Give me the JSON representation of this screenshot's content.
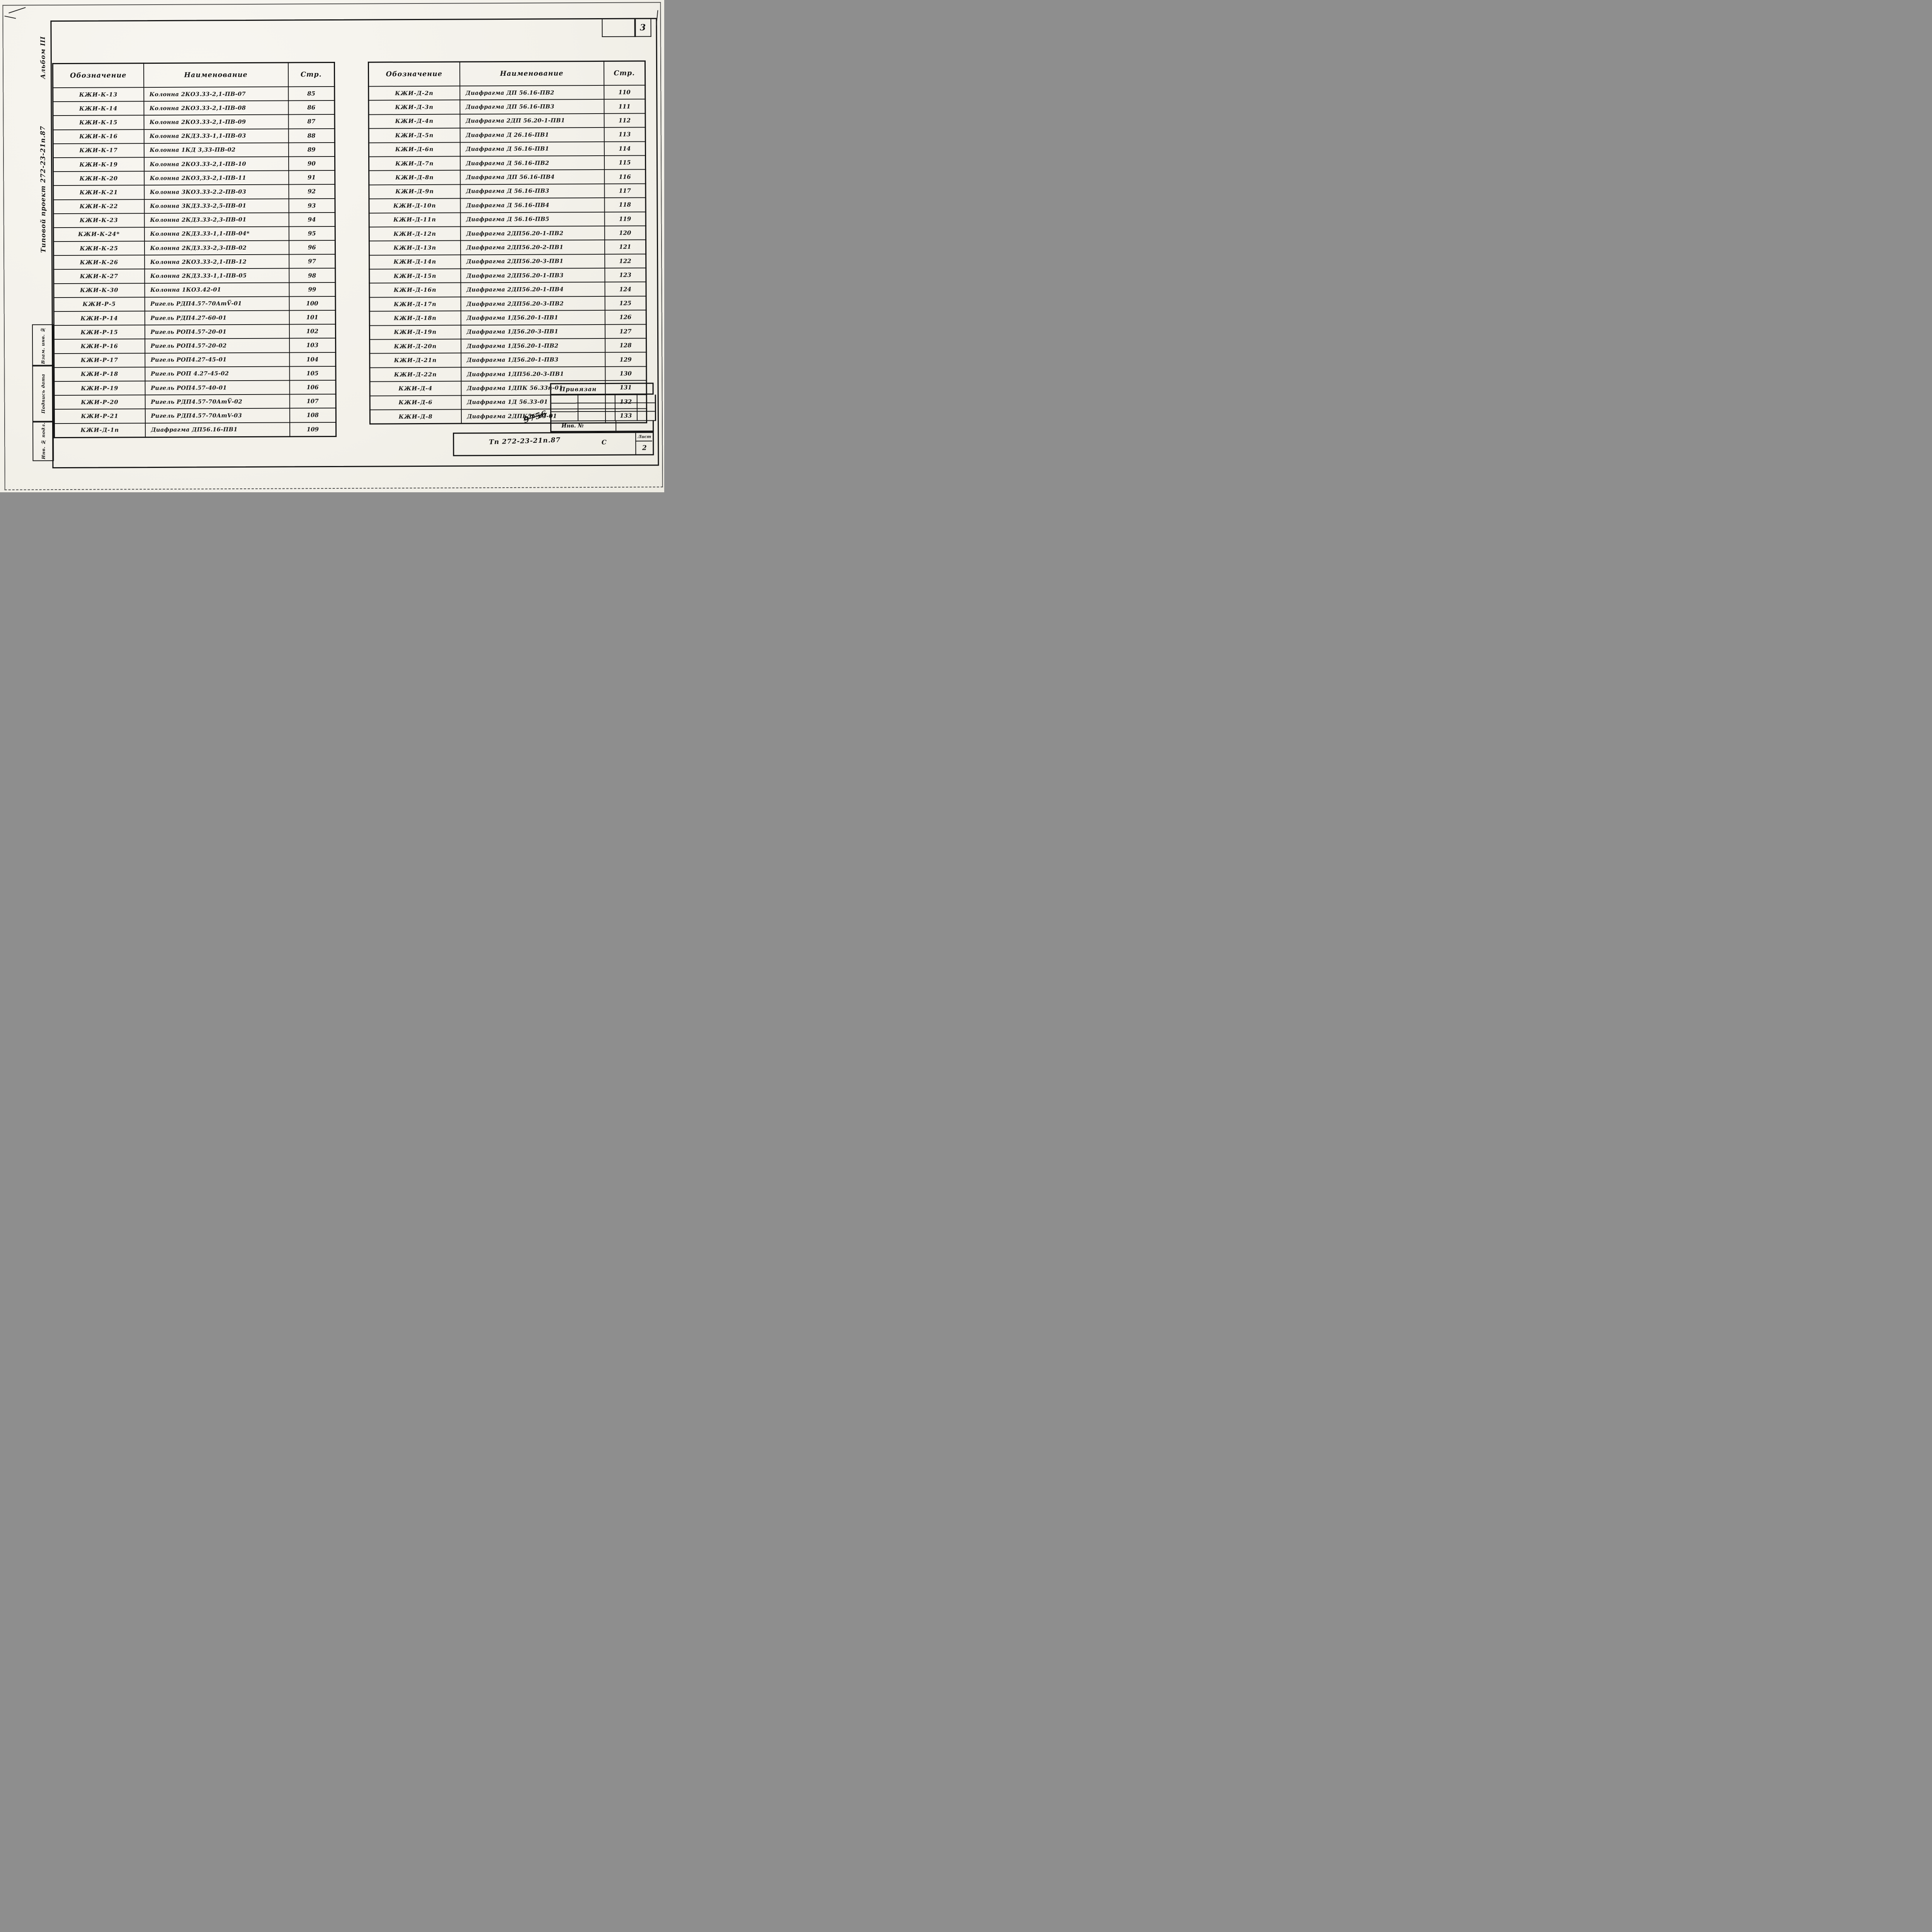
{
  "page": {
    "sheet_number_top": "3",
    "sheet_number_bottom": "2"
  },
  "margin": {
    "album": "Альбом III",
    "project": "Типовой проект 272-23-21п.87",
    "stamps": [
      "Взам. инв. №",
      "Подпись дата",
      "Инв. № подл."
    ]
  },
  "tables": {
    "headers": {
      "designation": "Обозначение",
      "name": "Наименование",
      "page": "Стр."
    },
    "left": {
      "rows": [
        [
          "КЖИ-К-13",
          "Колонна 2КО3.33-2,1-ПВ-07",
          "85"
        ],
        [
          "КЖИ-К-14",
          "Колонна 2КО3.33-2,1-ПВ-08",
          "86"
        ],
        [
          "КЖИ-К-15",
          "Колонна 2КО3.33-2,1-ПВ-09",
          "87"
        ],
        [
          "КЖИ-К-16",
          "Колонна 2КД3.33-1,1-ПВ-03",
          "88"
        ],
        [
          "КЖИ-К-17",
          "Колонна 1КД 3,33-ПВ-02",
          "89"
        ],
        [
          "КЖИ-К-19",
          "Колонна 2КО3.33-2,1-ПВ-10",
          "90"
        ],
        [
          "КЖИ-К-20",
          "Колонна 2КО3,33-2,1-ПВ-11",
          "91"
        ],
        [
          "КЖИ-К-21",
          "Колонна 3КО3.33-2.2-ПВ-03",
          "92"
        ],
        [
          "КЖИ-К-22",
          "Колонна 3КД3.33-2,5-ПВ-01",
          "93"
        ],
        [
          "КЖИ-К-23",
          "Колонна 2КД3.33-2,3-ПВ-01",
          "94"
        ],
        [
          "КЖИ-К-24*",
          "Колонна 2КД3.33-1,1-ПВ-04*",
          "95"
        ],
        [
          "КЖИ-К-25",
          "Колонна 2КД3.33-2,3-ПВ-02",
          "96"
        ],
        [
          "КЖИ-К-26",
          "Колонна 2КО3.33-2,1-ПВ-12",
          "97"
        ],
        [
          "КЖИ-К-27",
          "Колонна 2КД3.33-1,1-ПВ-05",
          "98"
        ],
        [
          "КЖИ-К-30",
          "Колонна 1КО3.42-01",
          "99"
        ],
        [
          "КЖИ-Р-5",
          "Ригель РДП4.57-70АтV̅-01",
          "100"
        ],
        [
          "КЖИ-Р-14",
          "Ригель РДП4.27-60-01",
          "101"
        ],
        [
          "КЖИ-Р-15",
          "Ригель РОП4.57-20-01",
          "102"
        ],
        [
          "КЖИ-Р-16",
          "Ригель РОП4.57-20-02",
          "103"
        ],
        [
          "КЖИ-Р-17",
          "Ригель РОП4.27-45-01",
          "104"
        ],
        [
          "КЖИ-Р-18",
          "Ригель РОП 4.27-45-02",
          "105"
        ],
        [
          "КЖИ-Р-19",
          "Ригель РОП4.57-40-01",
          "106"
        ],
        [
          "КЖИ-Р-20",
          "Ригель РДП4.57-70АтV̅-02",
          "107"
        ],
        [
          "КЖИ-Р-21",
          "Ригель РДП4.57-70АтV-03",
          "108"
        ],
        [
          "КЖИ-Д-1п",
          "Диафрагма ДП56.16-ПВ1",
          "109"
        ]
      ]
    },
    "right": {
      "rows": [
        [
          "КЖИ-Д-2п",
          "Диафрагма ДП 56.16-ПВ2",
          "110"
        ],
        [
          "КЖИ-Д-3п",
          "Диафрагма ДП 56.16-ПВ3",
          "111"
        ],
        [
          "КЖИ-Д-4п",
          "Диафрагма 2ДП 56.20-1-ПВ1",
          "112"
        ],
        [
          "КЖИ-Д-5п",
          "Диафрагма Д 26.16-ПВ1",
          "113"
        ],
        [
          "КЖИ-Д-6п",
          "Диафрагма Д 56.16-ПВ1",
          "114"
        ],
        [
          "КЖИ-Д-7п",
          "Диафрагма Д 56.16-ПВ2",
          "115"
        ],
        [
          "КЖИ-Д-8п",
          "Диафрагма ДП 56.16-ПВ4",
          "116"
        ],
        [
          "КЖИ-Д-9п",
          "Диафрагма Д 56.16-ПВ3",
          "117"
        ],
        [
          "КЖИ-Д-10п",
          "Диафрагма Д 56.16-ПВ4",
          "118"
        ],
        [
          "КЖИ-Д-11п",
          "Диафрагма Д 56.16-ПВ5",
          "119"
        ],
        [
          "КЖИ-Д-12п",
          "Диафрагма 2ДП56.20-1-ПВ2",
          "120"
        ],
        [
          "КЖИ-Д-13п",
          "Диафрагма 2ДП56.20-2-ПВ1",
          "121"
        ],
        [
          "КЖИ-Д-14п",
          "Диафрагма 2ДП56.20-3-ПВ1",
          "122"
        ],
        [
          "КЖИ-Д-15п",
          "Диафрагма 2ДП56.20-1-ПВ3",
          "123"
        ],
        [
          "КЖИ-Д-16п",
          "Диафрагма 2ДП56.20-1-ПВ4",
          "124"
        ],
        [
          "КЖИ-Д-17п",
          "Диафрагма 2ДП56.20-3-ПВ2",
          "125"
        ],
        [
          "КЖИ-Д-18п",
          "Диафрагма 1Д56.20-1-ПВ1",
          "126"
        ],
        [
          "КЖИ-Д-19п",
          "Диафрагма 1Д56.20-3-ПВ1",
          "127"
        ],
        [
          "КЖИ-Д-20п",
          "Диафрагма 1Д56.20-1-ПВ2",
          "128"
        ],
        [
          "КЖИ-Д-21п",
          "Диафрагма 1Д56.20-1-ПВ3",
          "129"
        ],
        [
          "КЖИ-Д-22п",
          "Диафрагма 1ДП56.20-3-ПВ1",
          "130"
        ],
        [
          "КЖИ-Д-4",
          "Диафрагма 1ДПК 56.33п-01",
          "131"
        ],
        [
          "КЖИ-Д-6",
          "Диафрагма 1Д 56.33-01",
          "132"
        ],
        [
          "КЖИ-Д-8",
          "Диафрагма 2ДПК56-33-01",
          "133"
        ]
      ]
    }
  },
  "title_block": {
    "status": "Привязан",
    "inv_label": "Инв. №",
    "inv_scribble": "9756",
    "doc_number": "Тп 272-23-21п.87",
    "letter": "С",
    "list_label": "Лист",
    "list_number": "2"
  }
}
